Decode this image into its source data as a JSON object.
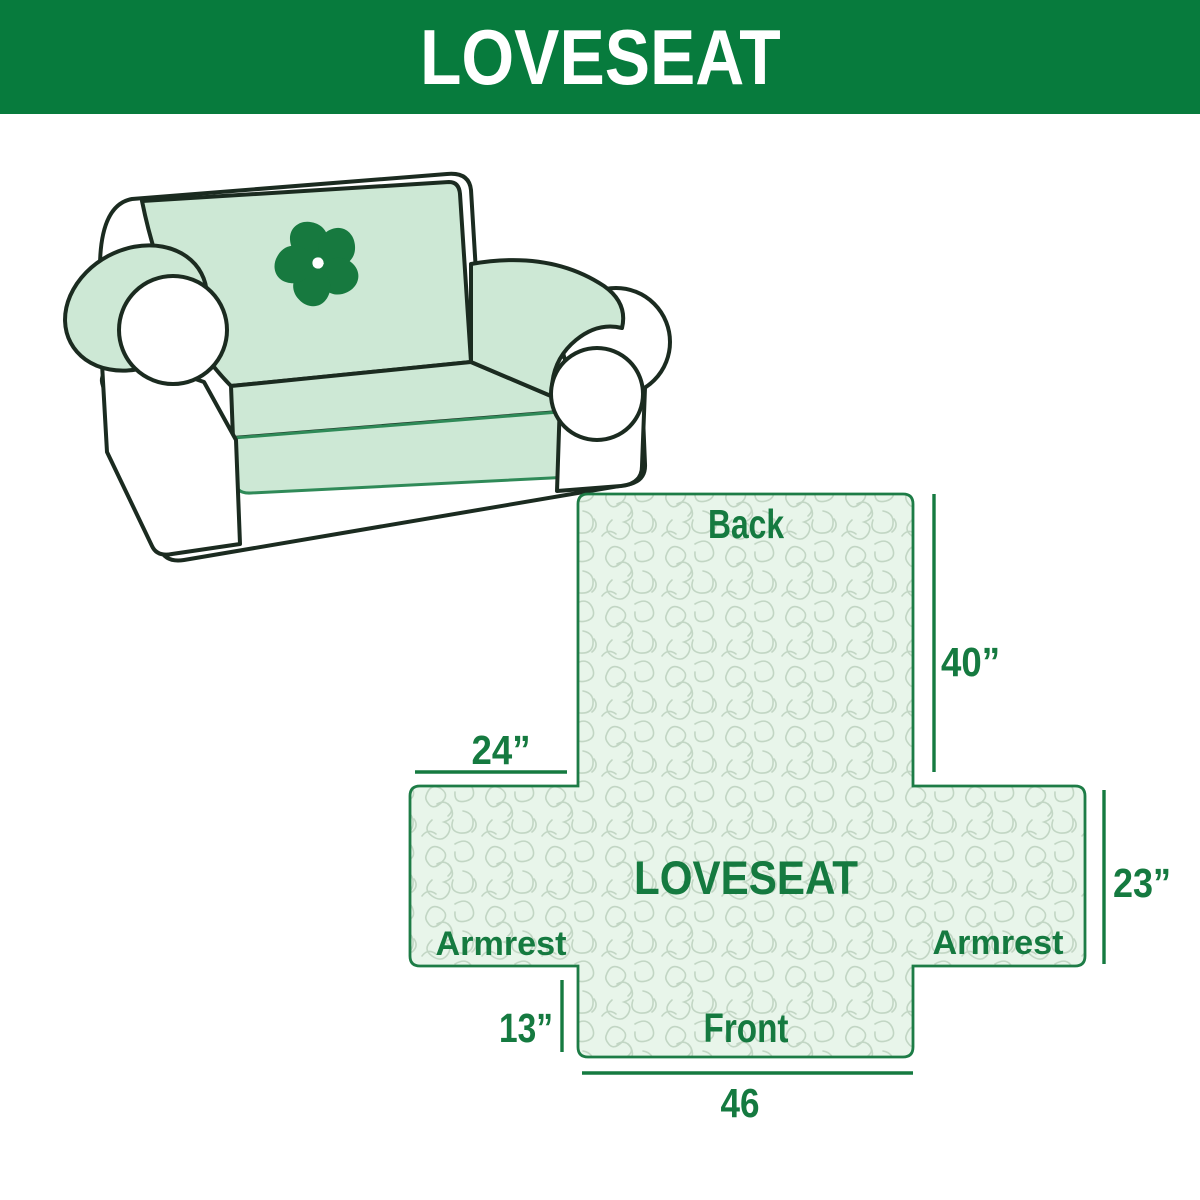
{
  "header": {
    "title": "LOVESEAT"
  },
  "illustration": {
    "alt": "Line drawing of a loveseat sofa fitted with a light green quilted cover",
    "logo_icon": "pinwheel-icon"
  },
  "diagram": {
    "center_label": "LOVESEAT",
    "labels": {
      "back": "Back",
      "front": "Front",
      "armrest_left": "Armrest",
      "armrest_right": "Armrest"
    },
    "dims": {
      "back_height": "40”",
      "armrest_top_width": "24”",
      "side_height": "23”",
      "front_drop": "13”",
      "front_width": "46"
    }
  },
  "colors": {
    "header_bg": "#077b3d",
    "header_text": "#ffffff",
    "diagram_green": "#157a40",
    "cross_fill": "#e8f5ea",
    "texture_line": "#c2d6c4",
    "cover_green": "#cde8d5",
    "outline_dark": "#1b2b20",
    "logo_green": "#17793f"
  }
}
